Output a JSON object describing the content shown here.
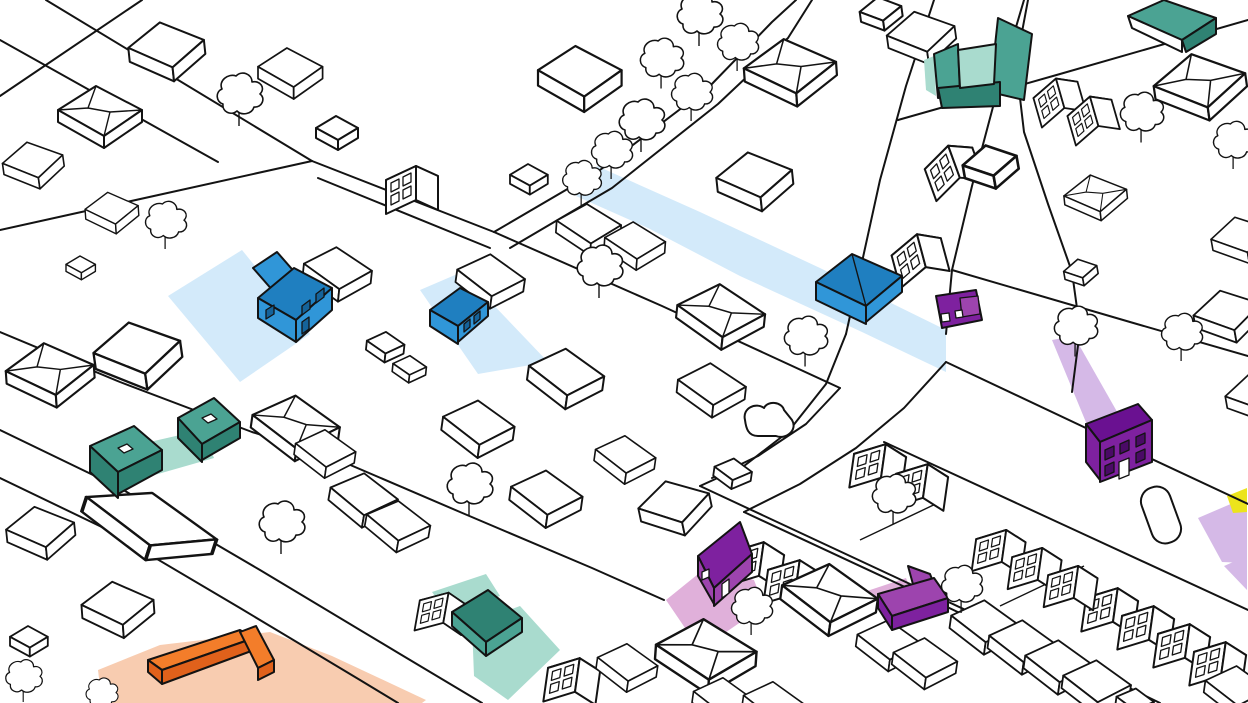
{
  "map": {
    "kind": "illustrated-isometric-village-map",
    "background": "#ffffff",
    "outline": "#131313"
  },
  "colors": {
    "blue": "#3096d8",
    "blue_dark": "#1f7fc0",
    "blue_deep": "#15639a",
    "blue_lot": "#d3eafa",
    "teal": "#4ba393",
    "teal_dark": "#2f8273",
    "teal_lot": "#a9dbce",
    "purple": "#9d44ae",
    "purple_dark": "#7e219f",
    "purple_deep": "#6a1191",
    "purple_win": "#4a0a66",
    "pink_lot": "#e0b0da",
    "lavender_lot": "#d5b9e7",
    "orange": "#f37d2a",
    "orange_dark": "#e0611b",
    "orange_lot": "#f8ccb0",
    "yellow": "#ece41c",
    "white": "#ffffff"
  },
  "features": {
    "highlighted_buildings": [
      {
        "id": "blue-house-west",
        "color": "blue"
      },
      {
        "id": "blue-house-mid",
        "color": "blue"
      },
      {
        "id": "blue-house-east",
        "color": "blue"
      },
      {
        "id": "teal-house-west-a",
        "color": "teal"
      },
      {
        "id": "teal-house-west-b",
        "color": "teal"
      },
      {
        "id": "teal-courtyard-northeast",
        "color": "teal"
      },
      {
        "id": "teal-roof-corner-northeast",
        "color": "teal"
      },
      {
        "id": "teal-barn-south",
        "color": "teal"
      },
      {
        "id": "orange-l-building-southwest",
        "color": "orange"
      },
      {
        "id": "purple-house-center",
        "color": "purple"
      },
      {
        "id": "purple-l-building-south",
        "color": "purple"
      },
      {
        "id": "purple-outbuilding-east",
        "color": "purple"
      },
      {
        "id": "purple-townhouse-east",
        "color": "purple"
      }
    ],
    "highlighted_zones": [
      {
        "id": "blue-lot-west",
        "color": "blue_lot"
      },
      {
        "id": "blue-lot-mid",
        "color": "blue_lot"
      },
      {
        "id": "blue-route-band",
        "color": "blue_lot"
      },
      {
        "id": "teal-lot-west",
        "color": "teal_lot"
      },
      {
        "id": "teal-courtyard-lot",
        "color": "teal_lot"
      },
      {
        "id": "teal-lot-south-upper",
        "color": "teal_lot"
      },
      {
        "id": "teal-lot-south-lower",
        "color": "teal_lot"
      },
      {
        "id": "orange-lot-southwest",
        "color": "orange_lot"
      },
      {
        "id": "pink-lot-center",
        "color": "pink_lot"
      },
      {
        "id": "pink-strip-south",
        "color": "pink_lot"
      },
      {
        "id": "lavender-band-east",
        "color": "lavender_lot"
      },
      {
        "id": "lavender-zone-east",
        "color": "lavender_lot"
      },
      {
        "id": "lavender-patch-east",
        "color": "lavender_lot"
      },
      {
        "id": "yellow-sliver-east",
        "color": "yellow"
      }
    ],
    "landmarks": [
      {
        "id": "pond"
      },
      {
        "id": "pool-court"
      }
    ]
  }
}
